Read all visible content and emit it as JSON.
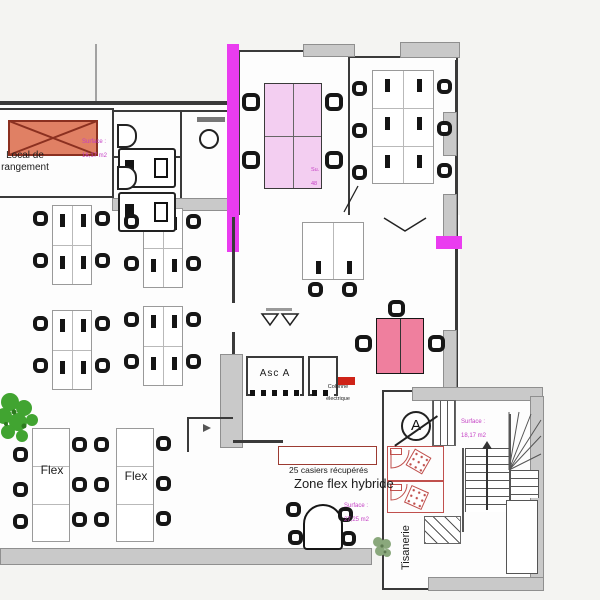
{
  "colors": {
    "highlight_magenta": "#ea3cf0",
    "table_light_pink": "#f3cef1",
    "table_rose": "#ef7f9e",
    "crossed_box_fill": "#e08064",
    "crossed_box_stroke": "#8b3020",
    "hatch_red": "#c0504d",
    "surface_text": "#c43ec4",
    "plant_green": "#41a431",
    "plant_gray_green": "#8aa87c",
    "badge_red": "#cf2318"
  },
  "labels": {
    "storage_room": "Local de rangement",
    "storage_surface_title": "Surface :",
    "storage_surface_value": "16,17 m2",
    "meeting_surface_title": "Su.",
    "meeting_surface_value": "48",
    "elevator": "Asc A",
    "electrical_line1": "Colonne",
    "electrical_line2": "électrique",
    "flex_table_left": "Flex",
    "flex_table_right": "Flex",
    "lockers": "25 casiers récupérés",
    "zone_flex": "Zone flex hybride",
    "zone_surface_title": "Surface :",
    "zone_surface_value": "27,25 m2",
    "tisanerie": "Tisanerie",
    "stairs_surface_title": "Surface :",
    "stairs_surface_value": "18,17 m2",
    "section_marker": "A"
  }
}
